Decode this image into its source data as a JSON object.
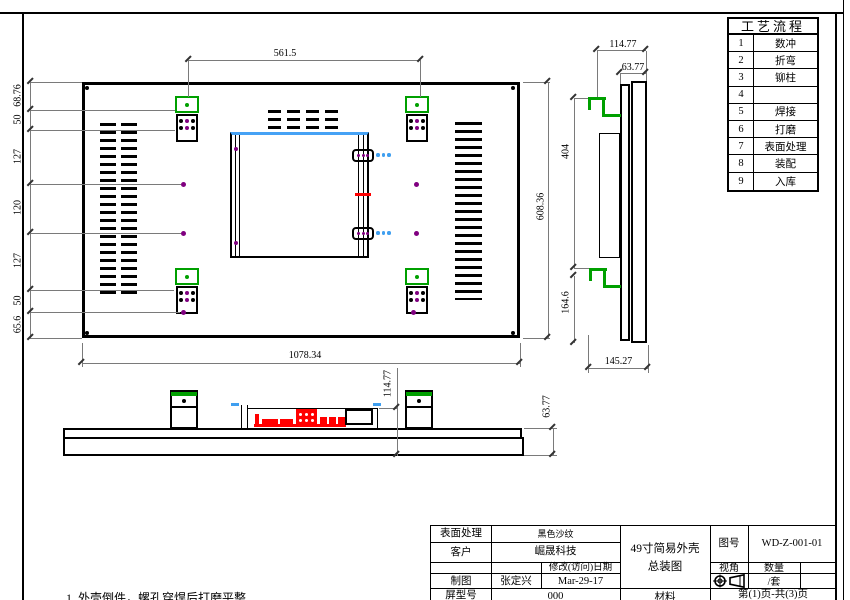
{
  "sheet": {
    "note": "1. 外壳倒件，螺孔穿焊后打磨平整"
  },
  "process_table": {
    "title": "工艺流程",
    "rows": [
      {
        "num": "1",
        "name": "数冲"
      },
      {
        "num": "2",
        "name": "折弯"
      },
      {
        "num": "3",
        "name": "铆柱"
      },
      {
        "num": "4",
        "name": ""
      },
      {
        "num": "5",
        "name": "焊接"
      },
      {
        "num": "6",
        "name": "打磨"
      },
      {
        "num": "7",
        "name": "表面处理"
      },
      {
        "num": "8",
        "name": "装配"
      },
      {
        "num": "9",
        "name": "入库"
      }
    ]
  },
  "dimensions": {
    "front": {
      "top_width": "561.5",
      "bottom_width": "1078.34",
      "right_height": "608.36",
      "left_chain": [
        "68.76",
        "50",
        "127",
        "120",
        "127",
        "50",
        "65.6"
      ]
    },
    "side": {
      "depth_total": "114.77",
      "depth_panel": "63.77",
      "hook_span": "404",
      "hook_bottom": "164.6",
      "bottom_width": "145.27"
    },
    "bottom": {
      "depth_total": "114.77",
      "bar_height": "63.77"
    }
  },
  "title_block": {
    "surface_label": "表面处理",
    "surface_value": "黑色沙纹",
    "customer_label": "客户",
    "customer_value": "崛晟科技",
    "date_label": "修改(访问)日期",
    "draft_label": "制图",
    "draft_value": "张定兴",
    "date_value": "Mar-29-17",
    "model_label": "屏型号",
    "model_value": "000",
    "drawing_title": "49寸简易外壳\n总装图",
    "drawing_no_label": "图号",
    "drawing_no_value": "WD-Z-001-01",
    "view_label": "视角",
    "qty_label": "数量",
    "qty_value": "/套",
    "material_label": "材料",
    "page_info": "第(1)页-共(3)页"
  },
  "colors": {
    "bracket_green": "#00A000",
    "hole_purple": "#800080",
    "highlight_blue": "#46A2F5",
    "connector_red": "#FF0000",
    "dim_gray": "#7A7A7A"
  }
}
